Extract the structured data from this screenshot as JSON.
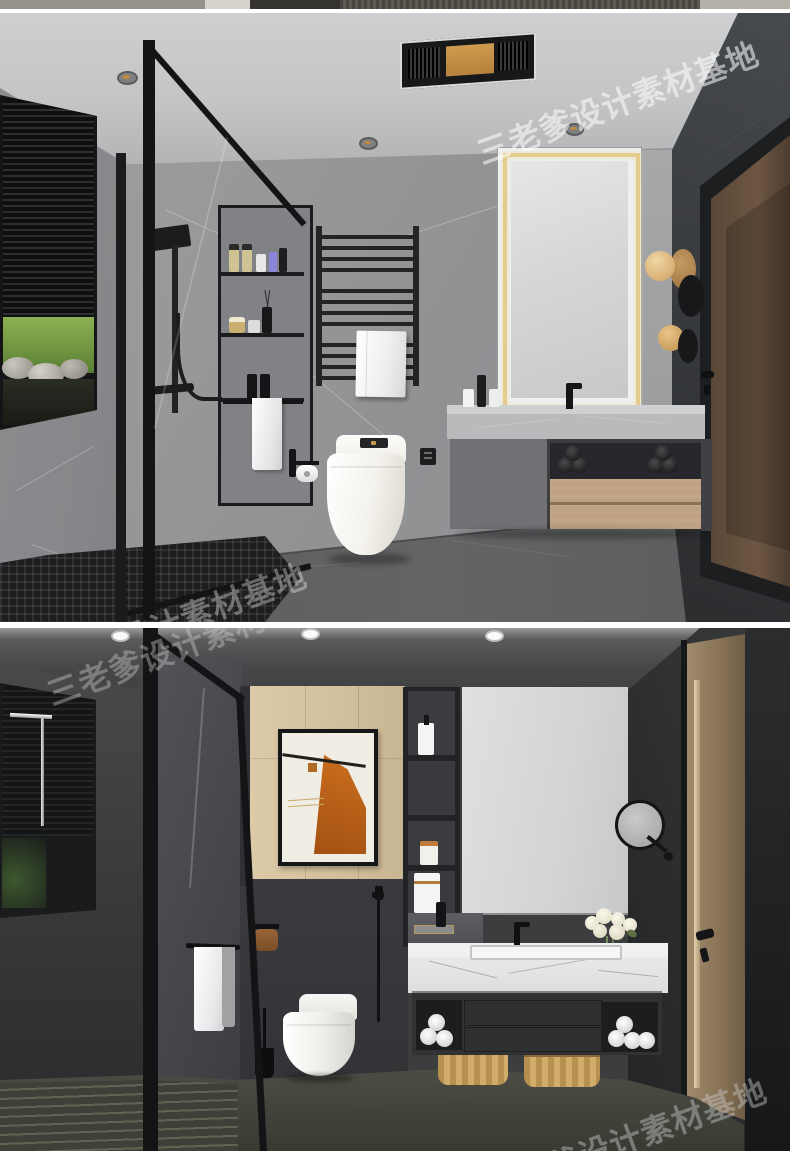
{
  "watermark": {
    "text": "三老爹设计素材基地"
  },
  "palette": {
    "divider": "#ffffff",
    "r1_ceiling": "#c6c8ca",
    "r1_back_wall": "#95979a",
    "r1_left_wall": "#8e9092",
    "r1_dark_accent_wall": "#3b3d40",
    "r1_floor": "#5d5f61",
    "r1_door_wood": "#5f4b3a",
    "r1_mirror_led_gold": "#e3cc8e",
    "r1_counter_marble": "#bcbdbf",
    "r1_drawer_wood": "#bfa284",
    "r1_grass": "#7aa046",
    "r1_fixture_black": "#141516",
    "r2_ceiling": "#46484a",
    "r2_wood_panel": "#d8c5a2",
    "r2_art_orange": "#c2601d",
    "r2_charcoal_wall": "#36383b",
    "r2_mirror": "#d4d6d8",
    "r2_counter_marble": "#e8e9ea",
    "r2_cabinet": "#303234",
    "r2_basket_wicker": "#c8a269",
    "r2_floor_stone": "#45463e"
  }
}
